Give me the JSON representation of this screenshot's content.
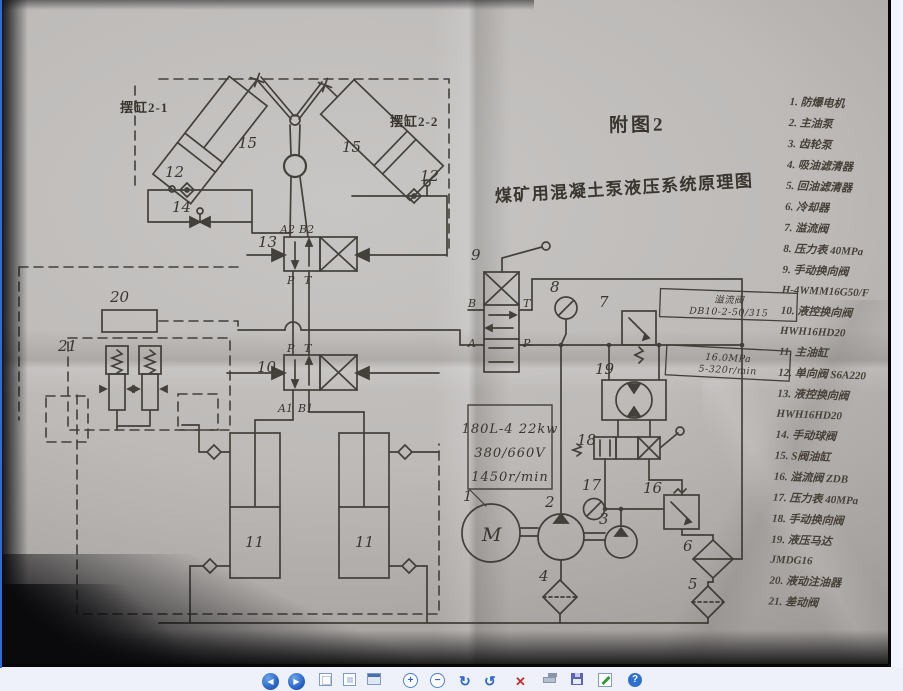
{
  "figure": {
    "title": "附图2",
    "subtitle": "煤矿用混凝土泵液压系统原理图",
    "swing_left": "摆缸2-1",
    "swing_right": "摆缸2-2",
    "motor_letter": "M",
    "spec": [
      "180L-4  22kw",
      "380/660V",
      "1450r/min"
    ],
    "note_relief": [
      "溢流阀",
      "DB10-2-50/315"
    ],
    "note_motor": [
      "16.0MPa",
      "5-320r/min"
    ],
    "ports": {
      "a2": "A2",
      "b2": "B2",
      "p1": "P",
      "t1": "T",
      "p2": "P",
      "t2": "T",
      "a1": "A1",
      "b1": "B1",
      "b": "B",
      "t3": "T",
      "a": "A",
      "p3": "P"
    },
    "callouts": {
      "c1": "1",
      "c2": "2",
      "c3": "3",
      "c4": "4",
      "c5": "5",
      "c6": "6",
      "c7": "7",
      "c8": "8",
      "c9": "9",
      "c10": "10",
      "c11a": "11",
      "c11b": "11",
      "c12a": "12",
      "c12b": "12",
      "c13": "13",
      "c14": "14",
      "c15a": "15",
      "c15b": "15",
      "c16": "16",
      "c17": "17",
      "c18": "18",
      "c19": "19",
      "c20": "20",
      "c21": "21"
    },
    "legend": {
      "items": [
        "1. 防爆电机",
        "2. 主油泵",
        "3. 齿轮泵",
        "4. 吸油滤清器",
        "5. 回油滤清器",
        "6. 冷却器",
        "7. 溢流阀",
        "8. 压力表 40MPa",
        "9. 手动换向阀\nH-4WMM16G50/F",
        "10. 液控换向阀\nHWH16HD20",
        "11. 主油缸",
        "12. 单向阀 S6A220",
        "13. 液控换向阀\nHWH16HD20",
        "14. 手动球阀",
        "15. S阀油缸",
        "16. 溢流阀 ZDB",
        "17. 压力表 40MPa",
        "18. 手动换向阀",
        "19. 液压马达\nJMDG16",
        "20. 液动注油器",
        "21. 差动阀"
      ]
    }
  },
  "toolbar": {
    "glyphs": {
      "prev": "◀",
      "next": "▶",
      "zoom_in": "+",
      "zoom_out": "−",
      "rotate_cw": "↻",
      "rotate_ccw": "↺",
      "delete": "✕",
      "help": "?"
    },
    "icons": [
      "previous-image-icon",
      "next-image-icon",
      "best-fit-icon",
      "actual-size-icon",
      "slide-show-icon",
      "zoom-in-icon",
      "zoom-out-icon",
      "rotate-clockwise-icon",
      "rotate-counterclockwise-icon",
      "delete-icon",
      "print-icon",
      "copy-to-icon",
      "edit-icon",
      "help-icon"
    ]
  },
  "colors": {
    "window_border": "#2e6bd8",
    "toolbar_bg": "#eef1fa",
    "delete_red": "#c03030",
    "icon_blue": "#2a66cc"
  }
}
